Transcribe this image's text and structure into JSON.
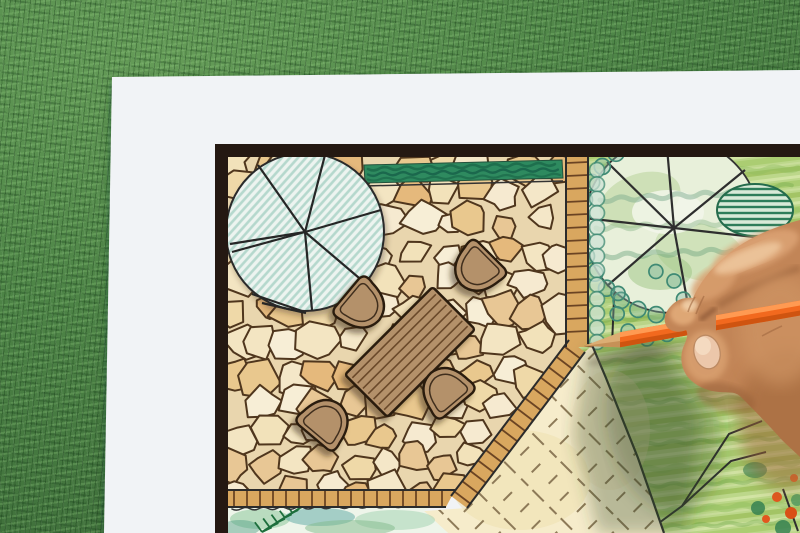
{
  "scene": {
    "type": "photograph",
    "subject": "Hand drawing a backyard garden landscape plan with an orange colored pencil",
    "setting": "White plan sheet with a dark border lying on green grass",
    "objects": [
      "grass background",
      "white paper sheet",
      "dark plan frame border",
      "flagstone patio drawing",
      "rectangular wooden garden table",
      "four shell-shaped chairs",
      "segmented tree canopy left",
      "segmented tree canopy right",
      "hedge strip",
      "tile edging strips",
      "lawn area with dash symbols",
      "planting bed with fern",
      "green planted garden area",
      "orange colored pencil",
      "hand holding pencil",
      "hand shadow on paper"
    ]
  },
  "colors": {
    "paper": "#f1f3f6",
    "frame": "#241812",
    "mortar": "#e9d6ae",
    "stone_outline": "#4f361d",
    "tile": "#d9a75f",
    "tile_line": "#6b4423",
    "plan_line": "#2b2b2b",
    "hedge": "#2e8a5f",
    "hedge_line": "#1d6b4b",
    "tree_bg": "#edf4f0",
    "tree_hatch": "#b5d8cd",
    "tree2_bg": "#e8f0da",
    "garden_base": "#bcd78a",
    "garden_row_dark": "#a3c465",
    "garden_row_light": "#d2e4a4",
    "scribble_green": "#8fbf5e",
    "scallop": "#3f8a74",
    "bush_dark": "#2e7d5a",
    "lawn": "#f6eccb",
    "lawn_dash": "#8d7a58",
    "wood": "#b4916b",
    "wood_line": "#6b4a2a",
    "outline_dark": "#2a1c10",
    "pencil_body": "#f2691e",
    "pencil_light": "#ff9a52",
    "pencil_dark": "#cf5410",
    "pencil_wood": "#dcae74",
    "pencil_wood_dark": "#c69157",
    "pencil_lead": "#6e4526",
    "skin": "#c28557",
    "skin_mid": "#d99f6e",
    "skin_light": "#ecc198",
    "skin_dark": "#8f5a34",
    "nail": "#ecc7aa",
    "flower_orange": "#e2571e",
    "bed_base": "#eef5ea"
  },
  "stone_palette": [
    "#f7eed6",
    "#f3e5c2",
    "#efd9a8",
    "#e9c88e",
    "#f2e2ba",
    "#e5b97c",
    "#f6ead0",
    "#f4e7c8",
    "#e8c795"
  ]
}
